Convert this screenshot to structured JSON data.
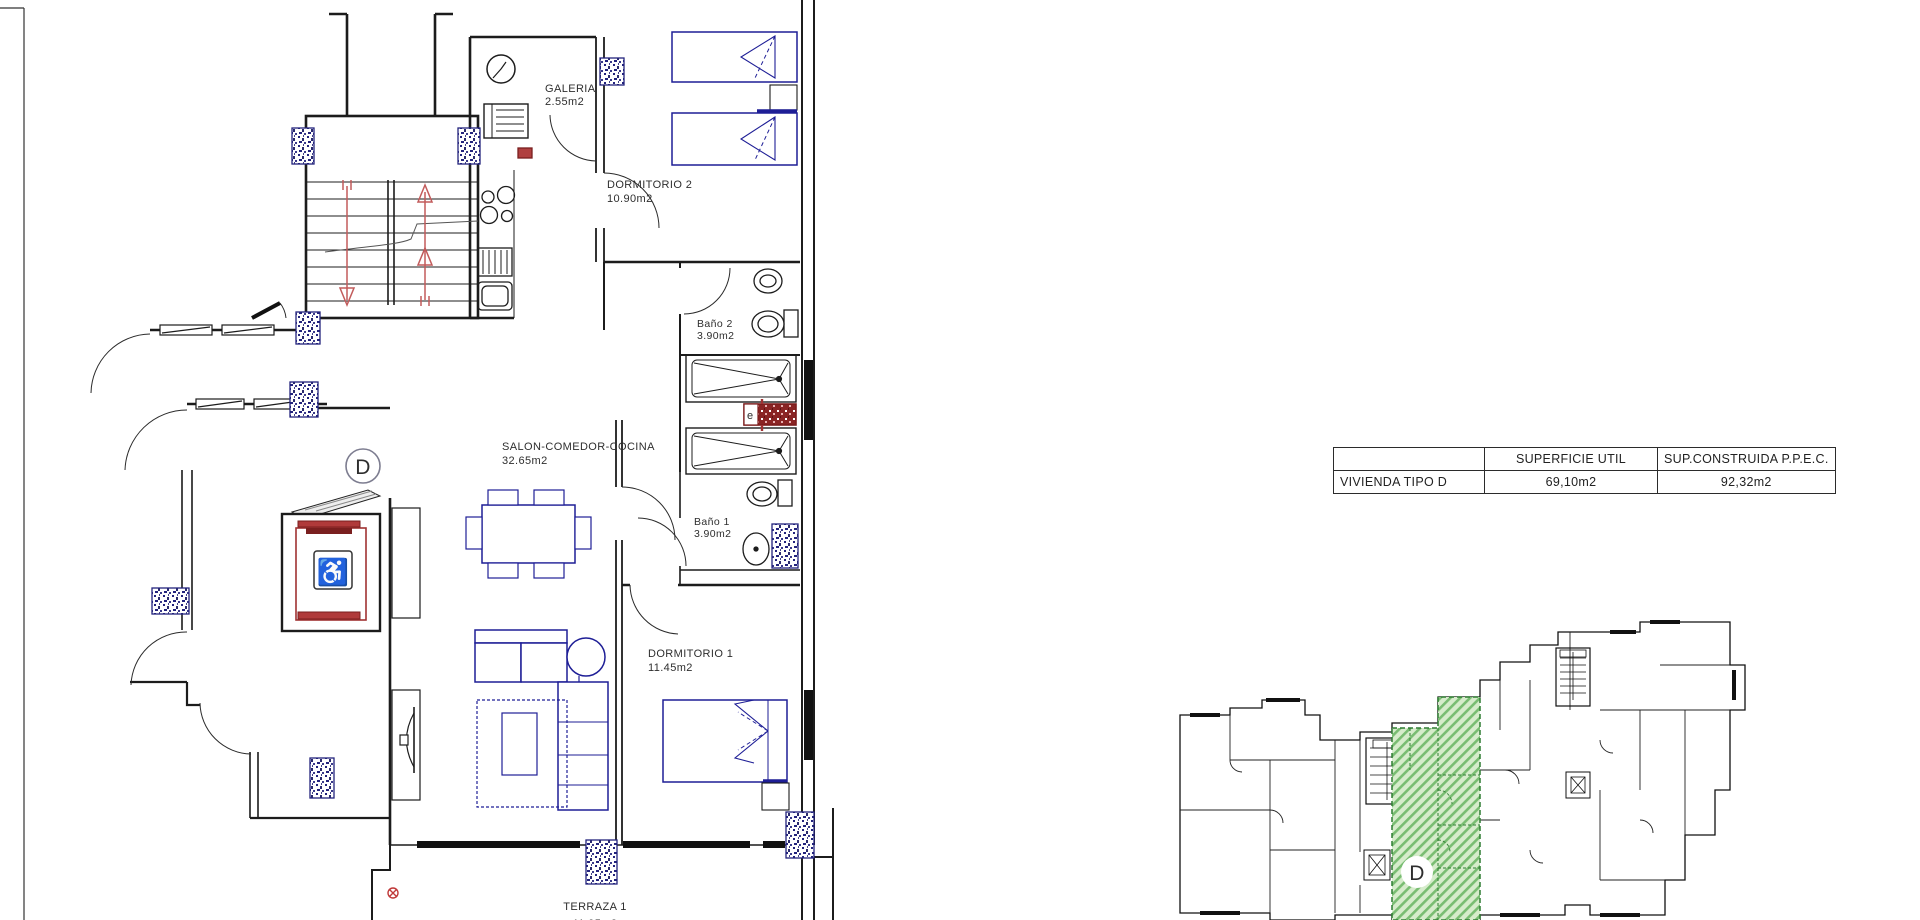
{
  "drawing_type": "architectural floor plan",
  "floor_plan": {
    "unit_marker": "D",
    "rooms": [
      {
        "name": "GALERIA",
        "area": "2.55m2"
      },
      {
        "name": "DORMITORIO 2",
        "area": "10.90m2"
      },
      {
        "name": "Baño 2",
        "area": "3.90m2"
      },
      {
        "name": "SALON-COMEDOR-COCINA",
        "area": "32.65m2"
      },
      {
        "name": "Baño 1",
        "area": "3.90m2"
      },
      {
        "name": "DORMITORIO 1",
        "area": "11.45m2"
      },
      {
        "name": "TERRAZA 1",
        "area": "11.95m2"
      }
    ],
    "duct_label": "e"
  },
  "summary_table": {
    "row_header": "VIVIENDA TIPO D",
    "col_superficie": "SUPERFICIE UTIL",
    "col_construida": "SUP.CONSTRUIDA P.P.E.C.",
    "superficie_value": "69,10m2",
    "construida_value": "92,32m2"
  },
  "key_plan": {
    "unit_marker": "D",
    "highlight_fill": "#d6eccb",
    "highlight_hatch": "#79bd72",
    "highlight_edge": "#2f7d32"
  },
  "colors": {
    "wall": "#1c1c1c",
    "furniture_blue": "#1e1e96",
    "stair_arrow_red": "#c25b5b",
    "elevator_red": "#a03232",
    "dark_red": "#7c1d1d",
    "column_speckle_blue": "#23237d",
    "marker_gray": "#9a9ab4"
  }
}
